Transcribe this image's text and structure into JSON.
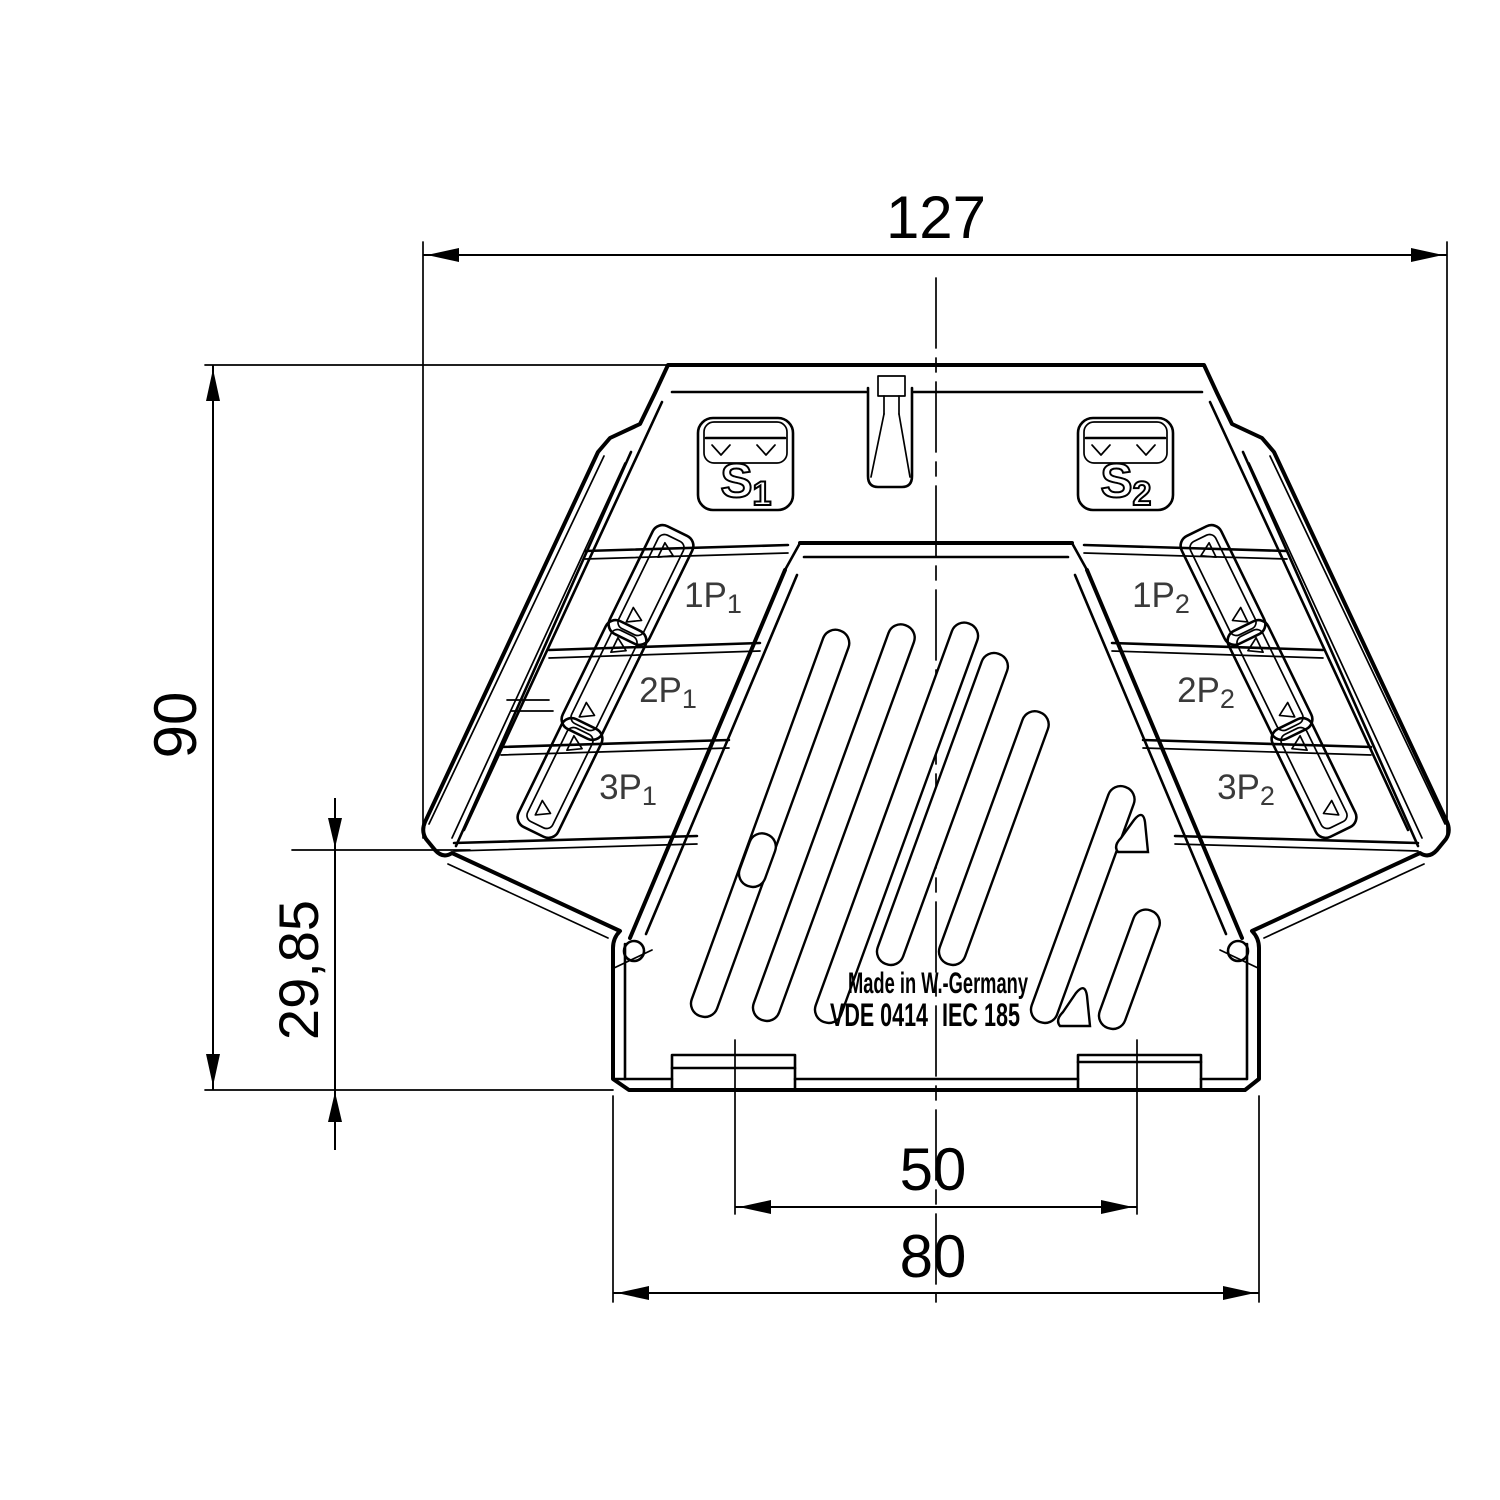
{
  "drawing": {
    "dimensions": {
      "width_top": "127",
      "height_total": "90",
      "height_flange": "29,85",
      "foot_spacing": "50",
      "base_width": "80"
    },
    "terminals": {
      "s1": {
        "main": "S",
        "sub": "1"
      },
      "s2": {
        "main": "S",
        "sub": "2"
      },
      "left": [
        {
          "main": "1P",
          "sub": "1"
        },
        {
          "main": "2P",
          "sub": "1"
        },
        {
          "main": "3P",
          "sub": "1"
        }
      ],
      "right": [
        {
          "main": "1P",
          "sub": "2"
        },
        {
          "main": "2P",
          "sub": "2"
        },
        {
          "main": "3P",
          "sub": "2"
        }
      ]
    },
    "branding": {
      "made_in": "Made in W.-Germany",
      "standard_left": "VDE 0414",
      "standard_right": "IEC 185"
    }
  }
}
